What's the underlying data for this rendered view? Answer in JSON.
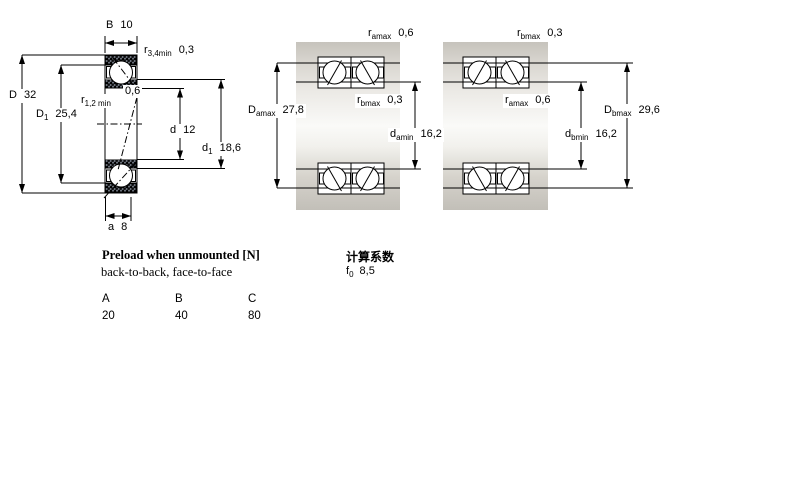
{
  "colors": {
    "line": "#000000",
    "bearing_fill": "#cfdcef",
    "bearing_hatch": "#8fabd2",
    "steel_light": "#fafaf8",
    "steel_dark": "#c2bfb8"
  },
  "left_diagram": {
    "labels": {
      "B": {
        "sym": "B",
        "sub": "",
        "value": "10"
      },
      "r34": {
        "sym": "r",
        "sub": "3,4min",
        "value": "0,3"
      },
      "D": {
        "sym": "D",
        "sub": "",
        "value": "32"
      },
      "D1": {
        "sym": "D",
        "sub": "1",
        "value": "25,4"
      },
      "r12": {
        "sym": "r",
        "sub": "1,2 min",
        "value": "0,6"
      },
      "d": {
        "sym": "d",
        "sub": "",
        "value": "12"
      },
      "d1": {
        "sym": "d",
        "sub": "1",
        "value": "18,6"
      },
      "a": {
        "sym": "a",
        "sub": "",
        "value": "8"
      }
    }
  },
  "middle_diagram": {
    "labels": {
      "r_amax": {
        "sym": "r",
        "sub": "amax",
        "value": "0,6"
      },
      "r_bmax": {
        "sym": "r",
        "sub": "bmax",
        "value": "0,3"
      },
      "D_amax": {
        "sym": "D",
        "sub": "amax",
        "value": "27,8"
      },
      "d_amin": {
        "sym": "d",
        "sub": "amin",
        "value": "16,2"
      }
    }
  },
  "right_diagram": {
    "labels": {
      "r_bmax": {
        "sym": "r",
        "sub": "bmax",
        "value": "0,3"
      },
      "r_amax": {
        "sym": "r",
        "sub": "amax",
        "value": "0,6"
      },
      "D_bmax": {
        "sym": "D",
        "sub": "bmax",
        "value": "29,6"
      },
      "d_bmin": {
        "sym": "d",
        "sub": "bmin",
        "value": "16,2"
      }
    }
  },
  "preload_section": {
    "title": "Preload when unmounted [N]",
    "subtitle": "back-to-back, face-to-face",
    "table": {
      "headers": [
        "A",
        "B",
        "C"
      ],
      "values": [
        "20",
        "40",
        "80"
      ]
    }
  },
  "calculation_section": {
    "title": "计算系数",
    "f0": {
      "sym": "f",
      "sub": "0",
      "value": "8,5"
    }
  }
}
